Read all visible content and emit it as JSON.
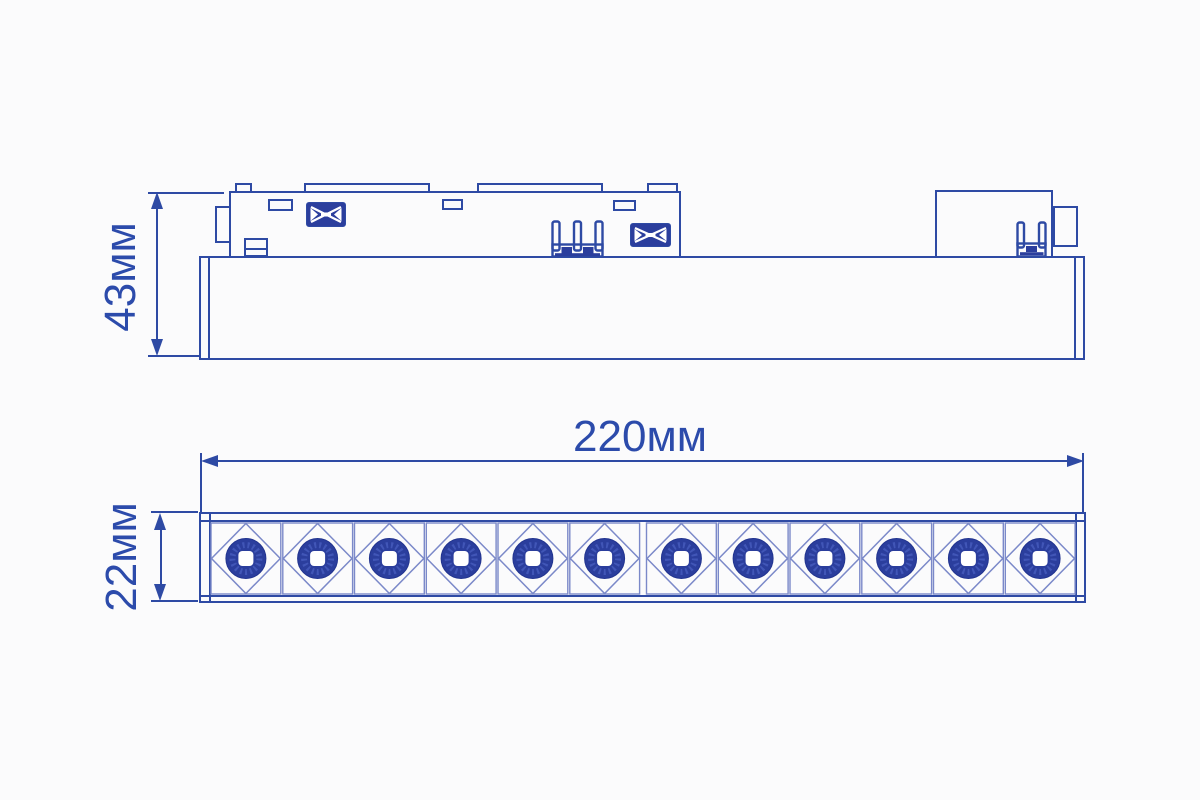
{
  "drawing": {
    "background": "#fbfbfc",
    "line_color": "#2e4aa4",
    "thin_line_color": "#7b89c9",
    "fill_color": "#2b3e9d",
    "speckle_color": "#4a5fc0",
    "text_color": "#2c4bab"
  },
  "side_view": {
    "height_dimension_label": "43мм"
  },
  "front_view": {
    "width_dimension_label": "220мм",
    "height_dimension_label": "22мм",
    "led_count": 12
  }
}
